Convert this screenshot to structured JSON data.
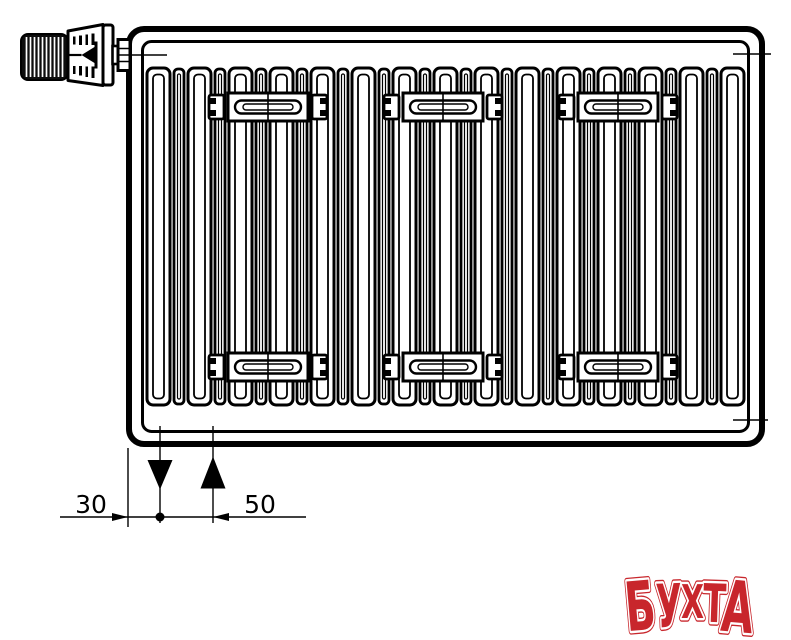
{
  "canvas": {
    "width": 791,
    "height": 640,
    "background": "#ffffff",
    "ink_color": "#000000"
  },
  "drawing": {
    "subject": "panel radiator with thermostatic valve head, front view, bottom connection",
    "dimension_labels": {
      "left": "30",
      "right": "50"
    },
    "connection_symbols": {
      "supply": "down-arrow",
      "return": "up-arrow"
    },
    "fins": {
      "x0": 147,
      "y0": 68,
      "height": 337,
      "modules": 15,
      "pitch": 41,
      "wide_width": 23,
      "narrow_width": 10,
      "narrow_offset": 27
    },
    "brackets": {
      "centers": [
        268,
        443,
        618
      ],
      "band_tops": [
        93,
        353
      ],
      "band_height": 28
    },
    "geometry": {
      "frame_left_x": 128,
      "supply_x": 160,
      "return_x": 213,
      "dim_line_y": 517
    }
  },
  "logo": {
    "text": "БУХТА",
    "fill": "#c8262c",
    "inner_outline": "#ffffff",
    "letters": [
      {
        "ch": "Б",
        "x": 625,
        "y": 630,
        "fs": 68,
        "w": 30,
        "rot": -5
      },
      {
        "ch": "У",
        "x": 656,
        "y": 627,
        "fs": 60,
        "w": 26,
        "rot": -2
      },
      {
        "ch": "Х",
        "x": 681,
        "y": 618,
        "fs": 46,
        "w": 23,
        "rot": 0
      },
      {
        "ch": "Т",
        "x": 703,
        "y": 622,
        "fs": 53,
        "w": 23,
        "rot": 2
      },
      {
        "ch": "А",
        "x": 722,
        "y": 632,
        "fs": 71,
        "w": 32,
        "rot": 5
      }
    ]
  }
}
